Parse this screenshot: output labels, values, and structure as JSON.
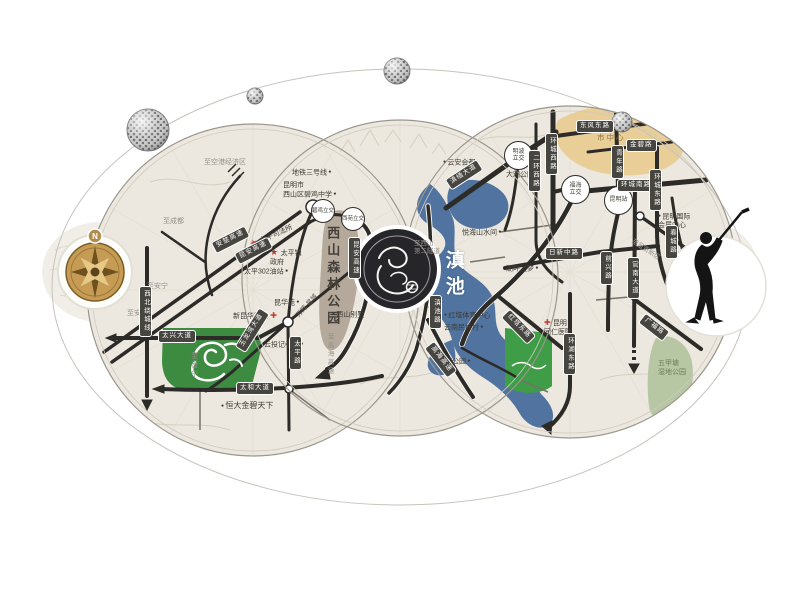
{
  "map": {
    "compass_n": "N",
    "lake_name": "滇池",
    "forest_park": "西山森林公园",
    "left": {
      "dir_airport": "至空港经济区",
      "dir_chengdu": "至成都",
      "dir_anning_1": "至安宁",
      "dir_anning_2": "至安宁",
      "dir_jinning": "至晋宁",
      "metro_line_3": "地铁三号线",
      "school": "昆明市\n西山区碧鸡中学",
      "taiping_court": "太平司法所",
      "taiping_gov": "太平镇\n政府",
      "taiping_oil_station": "太平302油站",
      "kunhua_yuan": "昆华苑",
      "new_kunhua_hospital": "新昆华医院",
      "wanhui_xingcheng": "万辉·星城",
      "yuntou_village": "云投记者村",
      "hengda_jinbi": "恒大金碧天下",
      "badges": {
        "anchu": "安楚高速",
        "kunan": "昆安高速",
        "kunan_s": "昆安高速",
        "ring_nw": "西北绕城线",
        "taixing": "太兴大道",
        "taihe": "太和大道",
        "yulongwan": "玉龙湾大道",
        "taiping_rd": "太平路"
      },
      "nodes": {
        "biji": "碧鸡立交",
        "xiyuan": "西苑立交"
      }
    },
    "middle": {
      "xishan_villa": "西山别墅",
      "to_gaohai": "至高海高速"
    },
    "right": {
      "nodes": {
        "mingbo": "明波\n立交",
        "fuhai": "福海\n立交",
        "km_station": "昆明站"
      },
      "daguan_park": "大观公园",
      "yunan_huidu": "云安会都",
      "city_center": "市中心",
      "expo_center": "昆明国际\n会展中心",
      "dir_chenggong": "至呈贡新区",
      "hupan_dream": "湖畔之梦",
      "yuehai": "悦海山水间",
      "xishan_tunnel": "至西山\n第二隧道",
      "hongta_sports": "红塔体育中心",
      "minzu_village": "云南民族村",
      "haigeng_park": "海埂公园",
      "tongren_hospital": "昆明\n同仁医院",
      "wetland_park": "五甲塘\n湿地公园",
      "badges": {
        "dongfeng": "东风东路",
        "jinbi": "金碧路",
        "qingnian": "青年路",
        "huancheng_nan": "环城南路",
        "huancheng_xi": "环城西路",
        "erhuan_xi": "二环西路",
        "dianmian": "滇缅大道",
        "huancheng_dong": "环城东路",
        "chuncheng": "春城路",
        "rixin": "日新中路",
        "qianxing": "前兴路",
        "guannan": "官南大道",
        "guangfu": "广福路",
        "hongta_dong": "红塔东路",
        "huanhu_dong": "环湖东路",
        "gaohai": "高海高速",
        "dianchi_rd": "滇池路"
      }
    }
  }
}
